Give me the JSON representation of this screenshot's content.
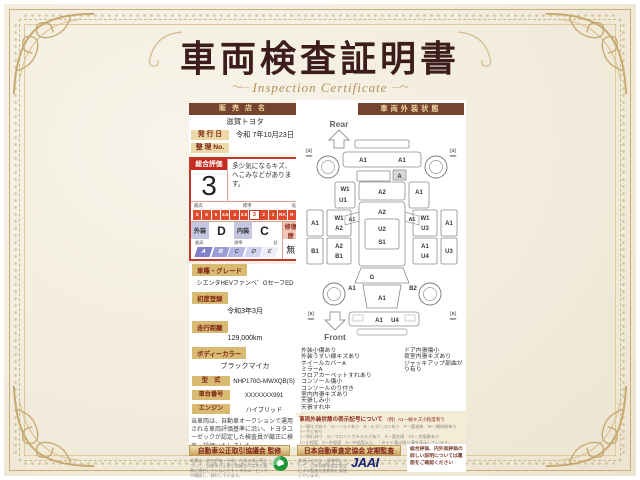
{
  "page": {
    "title": "車両検査証明書",
    "subtitle": "Inspection Certificate"
  },
  "colors": {
    "accent_red": "#c5281c",
    "bar_brown": "#75432f",
    "gold": "#b2925a",
    "toyota_red": "#eb0a1e",
    "badge_orange": "#ed7d18",
    "jaai_navy": "#16246e",
    "logo_green": "#1f9638"
  },
  "left": {
    "dealer_label": "販売店名",
    "dealer_value": "滋賀トヨタ",
    "issue_label": "発 行 日",
    "issue_value": "令和 7年10月23日",
    "manage_label": "整 理 No.",
    "manage_value": "",
    "eval": {
      "label": "総合評価",
      "grade": "3",
      "comment": "多少気になるキズ、へこみなどがあります。",
      "scale_labels": [
        "最高",
        "標準",
        "低"
      ],
      "scale": [
        "S",
        "6",
        "5",
        "4.5",
        "4",
        "3.5",
        "3",
        "2",
        "1",
        "RA",
        "R"
      ],
      "selected": "3",
      "ext_label": "外装",
      "ext_grade": "D",
      "int_label": "内装",
      "int_grade": "C",
      "repair_label": "修復歴",
      "repair_value": "無",
      "letter_labels": [
        "最高",
        "標準",
        "低"
      ],
      "letters": [
        "A",
        "B",
        "C",
        "D",
        "E"
      ]
    },
    "fields": [
      {
        "label": "車種・グレード",
        "value": "シエンタHEVファンベ゛GセーフED"
      },
      {
        "label": "初度登録",
        "value": "令和3年3月"
      },
      {
        "label": "走行距離",
        "value": "129,000km"
      },
      {
        "label": "ボディーカラー",
        "value": "ブラックマイカ"
      }
    ],
    "specs": [
      {
        "label": "型　式",
        "value": "NHP170G-MWXQB(S)"
      },
      {
        "label": "車台番号",
        "value": "XXXXXXX991"
      },
      {
        "label": "エンジン",
        "value": "ハイブリッド"
      }
    ],
    "toyota_logo": "TOYOTA",
    "inspector_badge": "トヨタ認定車両検査員",
    "inspector_no": "XXXXXX"
  },
  "right": {
    "header": "車両外装状態",
    "diagram": {
      "rear_label": "Rear",
      "front_label": "Front",
      "tire_rear": "[4]",
      "tire_front": "[5]",
      "mm": "mm",
      "codes": [
        "A1",
        "A1",
        "A",
        "W1",
        "U1",
        "A2",
        "A1",
        "A2",
        "U2",
        "S1",
        "A1",
        "A1",
        "A1",
        "B1",
        "W1",
        "A2",
        "A2",
        "B1",
        "W1",
        "U3",
        "A1",
        "U4",
        "A1",
        "U3",
        "G",
        "A1",
        "B2",
        "A1",
        "A1",
        "U4"
      ]
    },
    "notes_col1": [
      "外装小傷あり",
      "外装うすい線キズあり",
      "ホイールカバーA",
      "ミラーA",
      "フロアカーペットすれあり",
      "コンソール傷小",
      "コンソールのり付き",
      "室内内張キズあり",
      "天張しみ小",
      "天張すれ中"
    ],
    "notes_col2": [
      "ドア内張傷小",
      "荷室内張キズあり",
      "ジャッキアップ部曲がり有り"
    ],
    "legend": {
      "title": "車両外装状態の表示記号について",
      "example": "（例）A1－線キズ小程度有り",
      "lines": [
        "A－線キズ有り　U－ヘコミ有り　B－キズヘコミ有り　P－要塗装　W－補修跡有り　S－サビ有り",
        "C－割れ有り　G－フロントガラスキズ有り　X－要交換　XX－交換跡有り",
        "1－小程度　2－中程度　3－中程度以上　・タイヤ溝は残り溝を表示しています。"
      ]
    }
  },
  "bottom": {
    "statement": "当車両は、自動車オークションで運用される車両評価基準に沿い、トヨタユーゼックが認定した検査員が厳正に検査・評価いたしました。",
    "ribbon1": "自動車公正取引協議会 監修",
    "ribbon1_note": "本書は、総合評価・外装・内装の表示等について、自動車公正取引協議会の定めた基準に適合していることをトヨタユーゼックが確認し、発行しています。",
    "ribbon2": "日本自動車査定協会 定期監査",
    "ribbon2_note": "本表示の方法・基準等について、日本自動車査定協会による監査を定期的に実施しています。",
    "jaai": "JAAI",
    "back_note": "総合評価、内外装評価の詳しい説明については裏面をご確認ください"
  }
}
